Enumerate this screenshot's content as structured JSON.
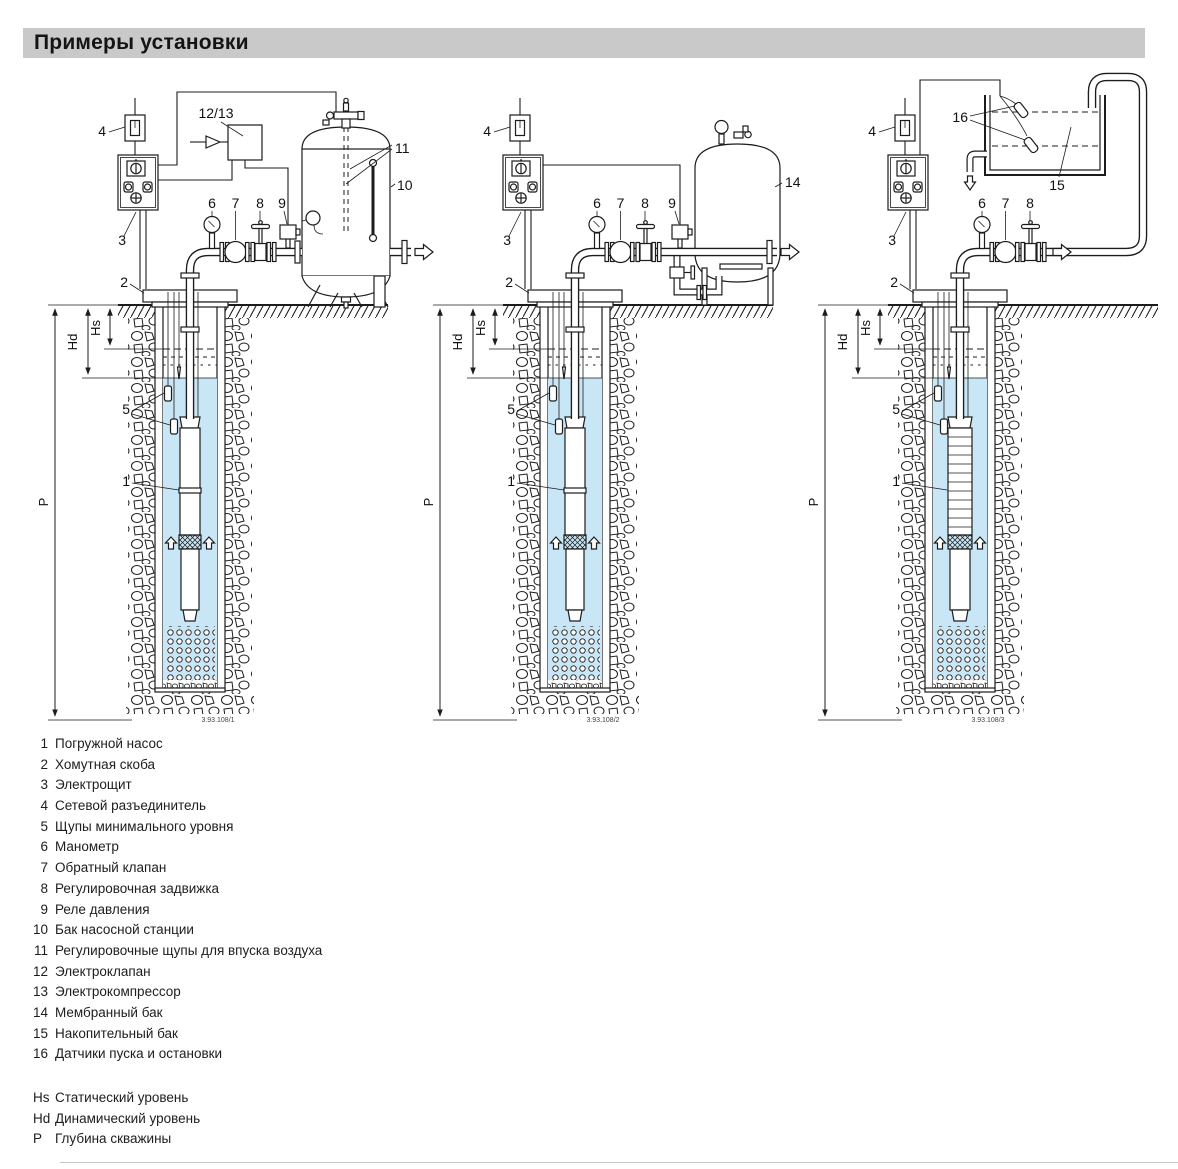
{
  "page": {
    "title": "Примеры установки"
  },
  "callouts": {
    "c1": "1",
    "c2": "2",
    "c3": "3",
    "c4": "4",
    "c5": "5",
    "c6": "6",
    "c7": "7",
    "c8": "8",
    "c9": "9",
    "c10": "10",
    "c11": "11",
    "c12_13": "12/13",
    "c14": "14",
    "c15": "15",
    "c16": "16"
  },
  "dims": {
    "hs": "Hs",
    "hd": "Hd",
    "p": "P"
  },
  "drawings": {
    "d1": "3.93.108/1",
    "d2": "3.93.108/2",
    "d3": "3.93.108/3"
  },
  "legend": {
    "items": [
      {
        "n": "1",
        "t": "Погружной насос"
      },
      {
        "n": "2",
        "t": "Хомутная скоба"
      },
      {
        "n": "3",
        "t": "Электрощит"
      },
      {
        "n": "4",
        "t": "Сетевой разъединитель"
      },
      {
        "n": "5",
        "t": "Щупы минимального уровня"
      },
      {
        "n": "6",
        "t": "Манометр"
      },
      {
        "n": "7",
        "t": "Обратный клапан"
      },
      {
        "n": "8",
        "t": "Регулировочная задвижка"
      },
      {
        "n": "9",
        "t": "Реле давления"
      },
      {
        "n": "10",
        "t": "Бак насосной станции"
      },
      {
        "n": "11",
        "t": "Регулировочные щупы для впуска воздуха"
      },
      {
        "n": "12",
        "t": "Электроклапан"
      },
      {
        "n": "13",
        "t": "Электрокомпрессор"
      },
      {
        "n": "14",
        "t": "Мембранный бак"
      },
      {
        "n": "15",
        "t": "Накопительный бак"
      },
      {
        "n": "16",
        "t": "Датчики пуска и остановки"
      }
    ]
  },
  "levels": {
    "items": [
      {
        "k": "Hs",
        "t": "Статический уровень"
      },
      {
        "k": "Hd",
        "t": "Динамический уровень"
      },
      {
        "k": "P",
        "t": "Глубина скважины"
      }
    ]
  },
  "colors": {
    "water": "#c8e6f6",
    "title_bar": "#c9c9c9"
  }
}
